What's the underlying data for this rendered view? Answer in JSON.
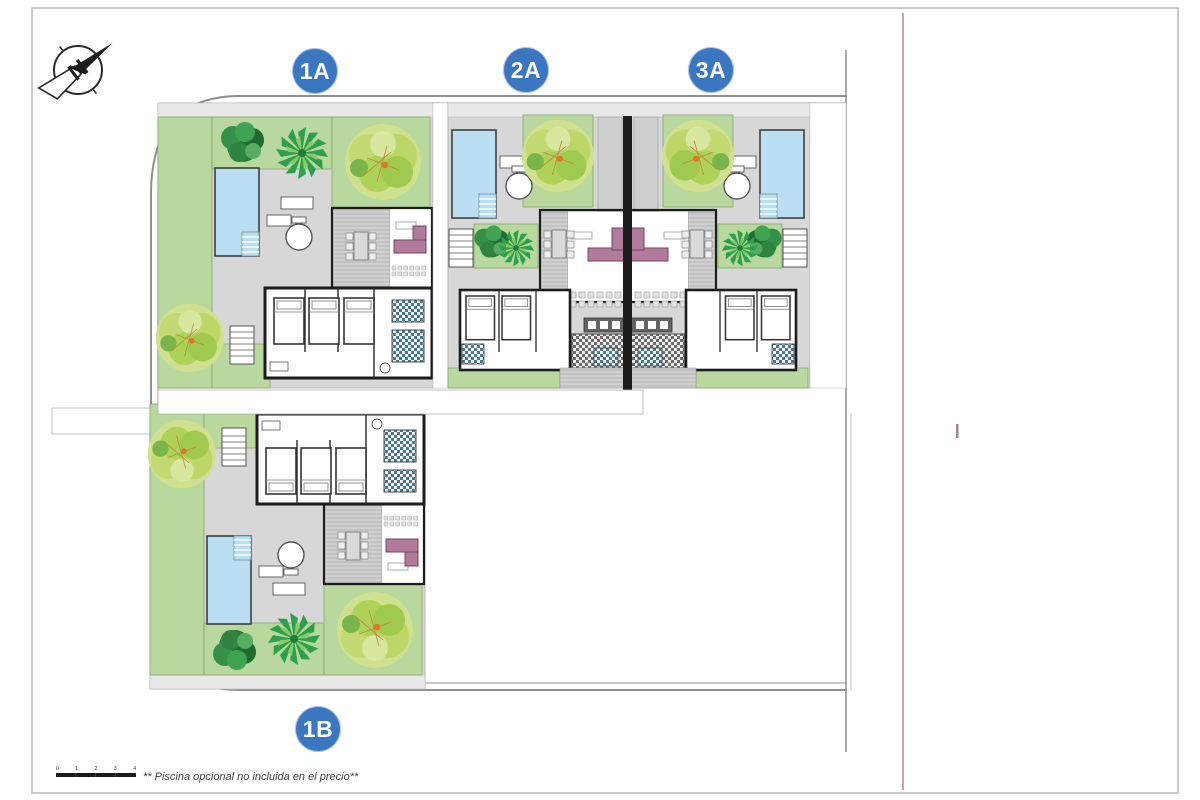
{
  "badges": [
    "1A",
    "2A",
    "3A",
    "1B"
  ],
  "compass": {
    "label": "N"
  },
  "footnote": "** Piscina opcional no incluida en el precio**",
  "scale_bar": {
    "ticks": [
      "0",
      "1",
      "2",
      "3",
      "4"
    ]
  },
  "colors": {
    "badge": "#3b76c0",
    "lawn": "#b9d89e",
    "lawnEdge": "#86a56b",
    "pool": "#badff2",
    "sofa": "#b27a9b",
    "paving": "#d7d7d7",
    "walkway": "#e8e8e8",
    "wall": "#1c1c1c",
    "road": "#8f8f8f",
    "frame": "#b9b9b9",
    "boundaryRed": "#8e4f57"
  }
}
